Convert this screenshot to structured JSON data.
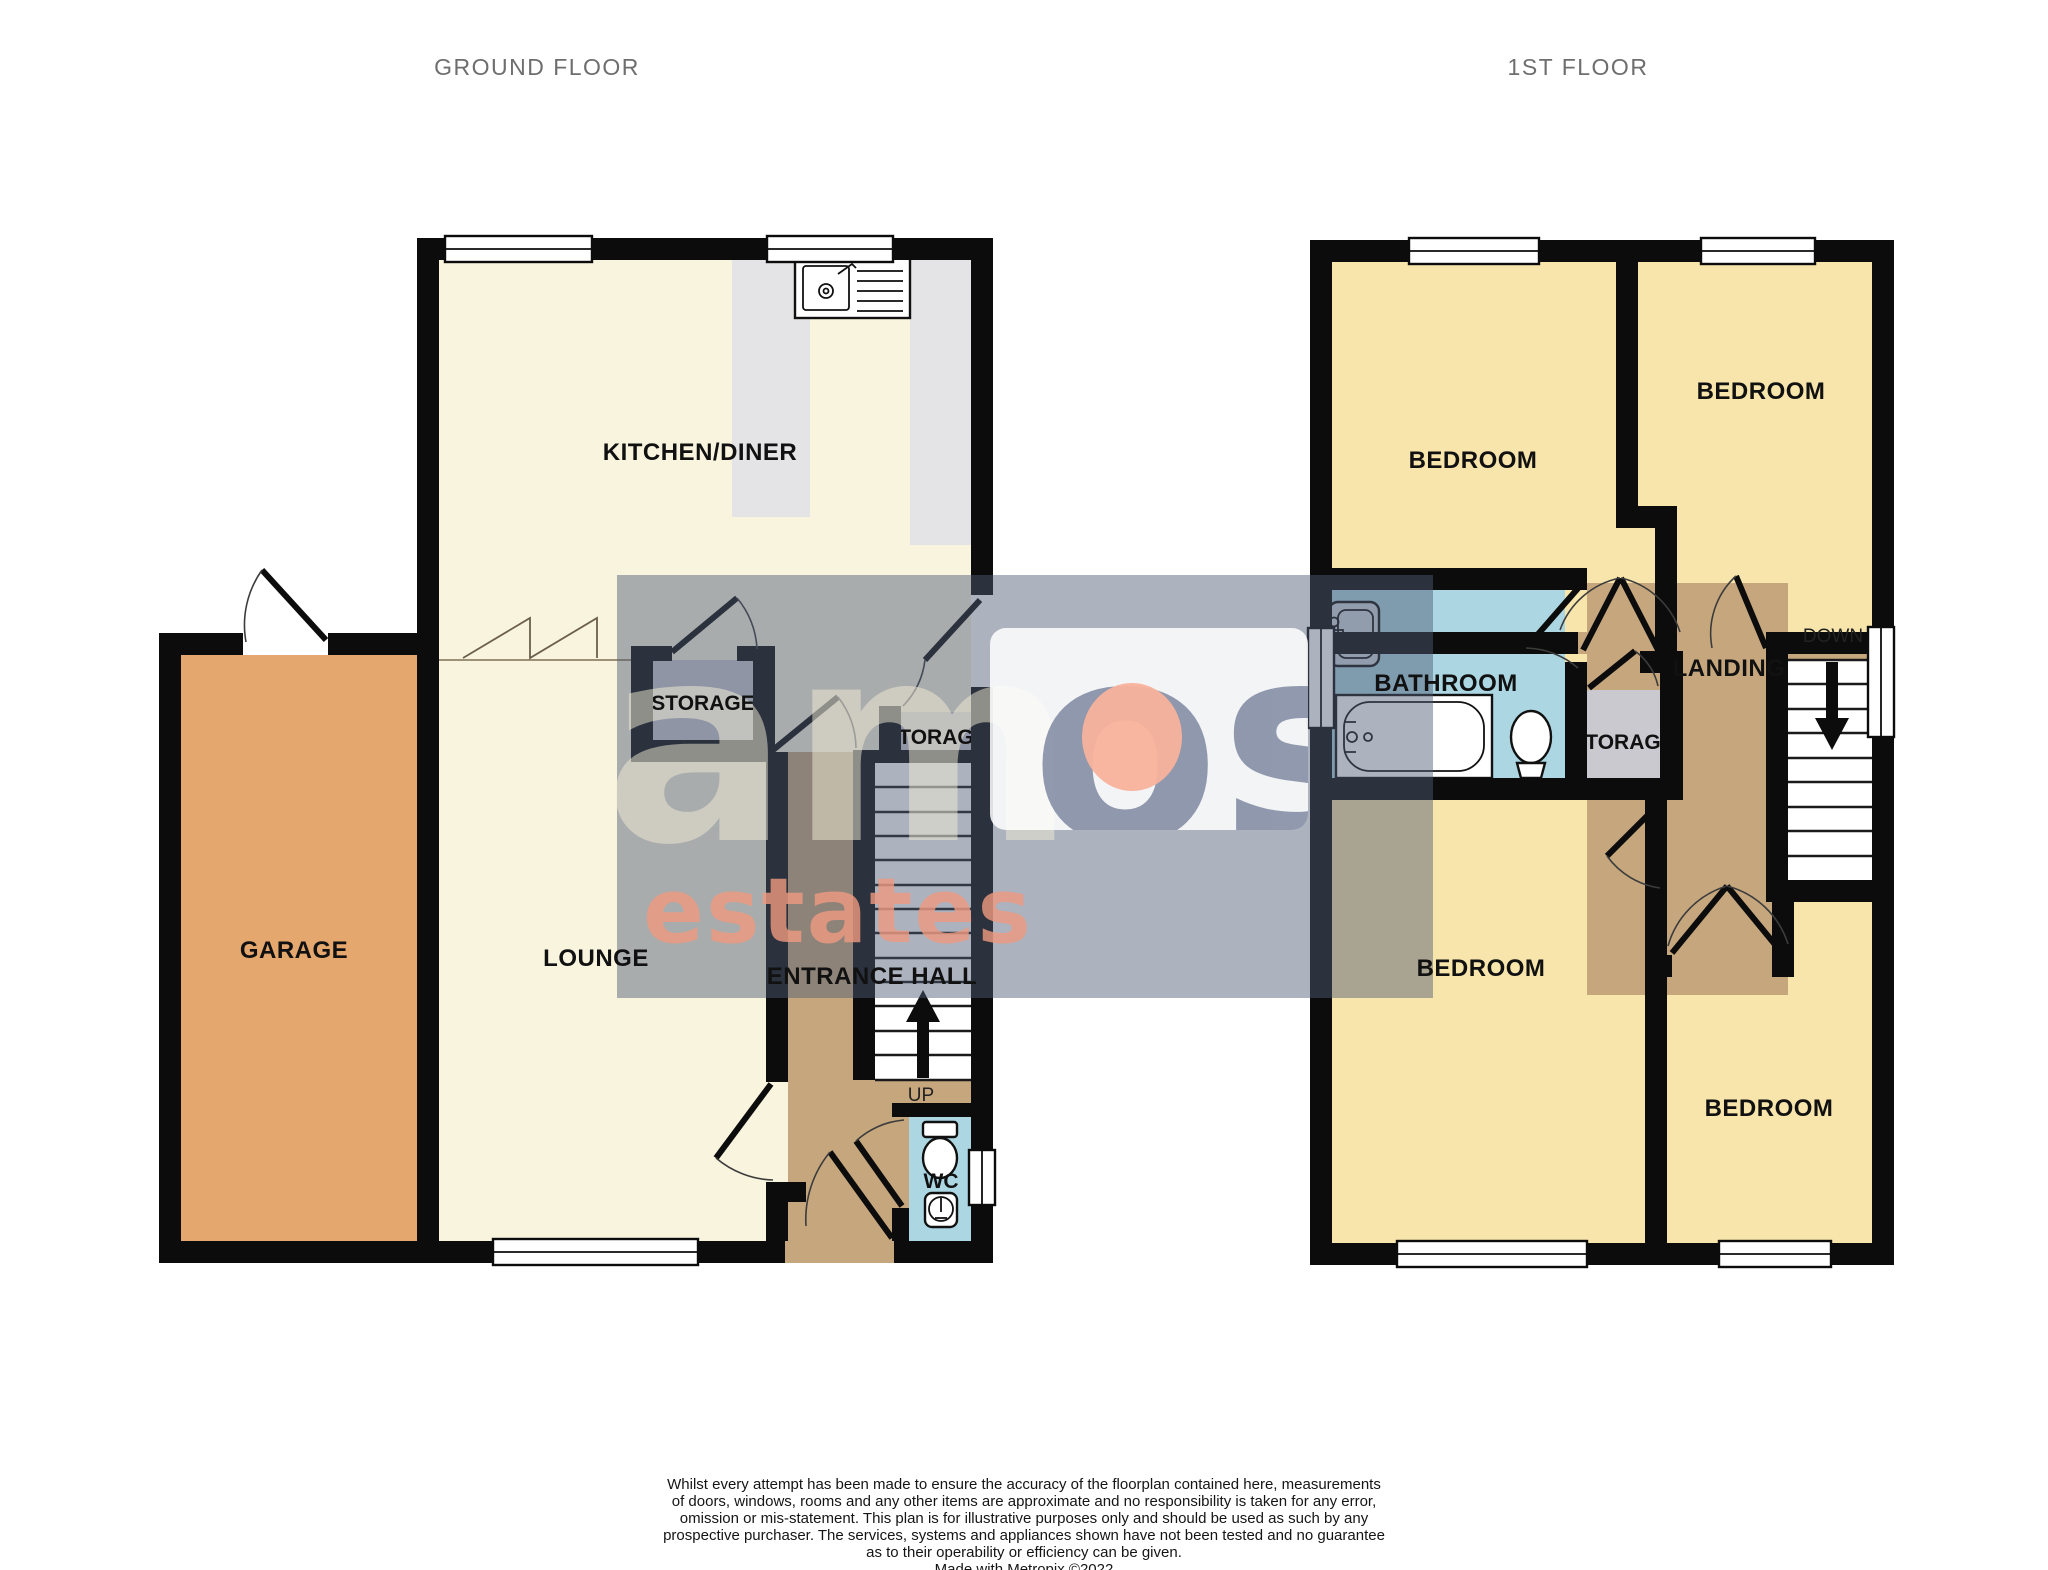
{
  "titles": {
    "ground": "GROUND FLOOR",
    "first": "1ST FLOOR"
  },
  "ground_floor": {
    "rooms": {
      "kitchen_diner": "KITCHEN/DINER",
      "lounge": "LOUNGE",
      "garage": "GARAGE",
      "entrance_hall": "ENTRANCE HALL",
      "storage_kitchen": "STORAGE",
      "storage_hall": "STORAGE",
      "wc": "WC"
    },
    "stair_direction": "UP"
  },
  "first_floor": {
    "rooms": {
      "bedroom_top_left": "BEDROOM",
      "bedroom_top_right": "BEDROOM",
      "bedroom_bottom_left": "BEDROOM",
      "bedroom_bottom_right": "BEDROOM",
      "bathroom": "BATHROOM",
      "storage": "STORAGE",
      "landing": "LANDING"
    },
    "stair_direction": "DOWN"
  },
  "watermark": {
    "word_left": "am",
    "word_right": "os",
    "subtitle": "estates"
  },
  "footer": {
    "disclaimer_lines": [
      "Whilst every attempt has been made to ensure the accuracy of the floorplan contained here, measurements",
      "of doors, windows, rooms and any other items are approximate and no responsibility is taken for any error,",
      "omission or mis-statement. This plan is for illustrative purposes only and should be used as such by any",
      "prospective purchaser. The services, systems and appliances shown have not been tested and no guarantee",
      "as to their operability or efficiency can be given.",
      "Made with Metropix ©2022"
    ]
  },
  "colors": {
    "room_cream": "#f9f4de",
    "bedroom_yellow": "#f7e5ab",
    "garage_orange": "#e4a76d",
    "hall_tan": "#c6a77d",
    "wet_blue": "#abd6e2",
    "storage_grey": "#c9c9cf",
    "worktop_grey": "#e4e4e6",
    "wall_black": "#0c0c0c",
    "watermark_grey": "#4f5b74",
    "watermark_light_letters": "#f3edd6",
    "watermark_dark_letters": "#8b94aa",
    "watermark_salmon": "#f8b29c",
    "watermark_estates": "#f09a80",
    "title_grey": "#6e6e6e"
  }
}
